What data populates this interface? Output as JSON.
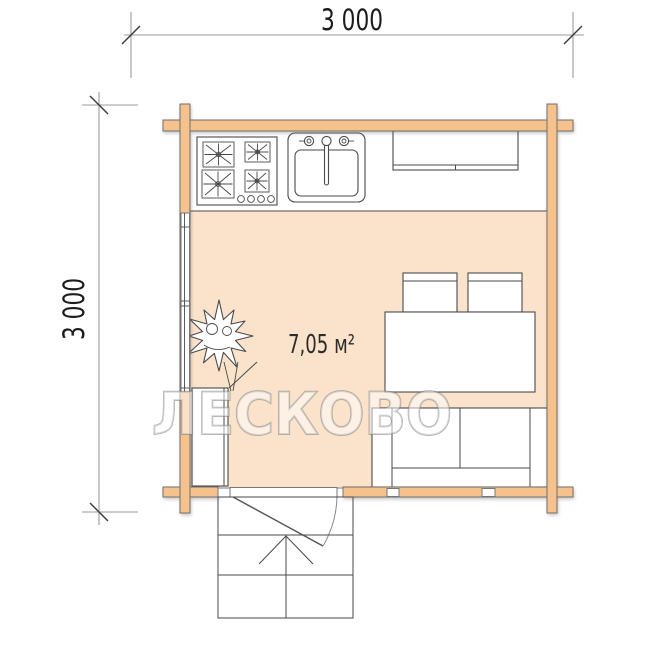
{
  "page": {
    "type": "log-cabin-floor-plan"
  },
  "dimensions": {
    "top_label": "3 000",
    "left_label": "3 000"
  },
  "room": {
    "area_label": "7,05 м²"
  },
  "watermark": {
    "text": "ЛЕСКОВО"
  },
  "colors": {
    "wood": "#F5C18C",
    "wood-outline": "#6E6E6E",
    "floor": "#FBE3CB",
    "line": "#4A4A4A",
    "dim-line": "#9B9B9B",
    "dim-text": "#1C1C1C"
  },
  "plan_items": [
    "gas-stove",
    "kitchen-sink",
    "kitchen-counter",
    "left-wall-window",
    "dining-table",
    "chair",
    "chair",
    "sofa",
    "wardrobe",
    "plant",
    "entrance-door",
    "porch-steps",
    "bottom-wall-windows"
  ]
}
